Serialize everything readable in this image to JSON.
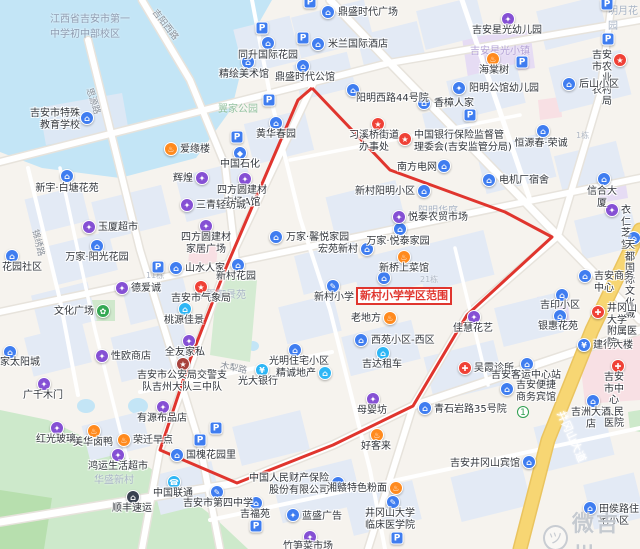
{
  "map": {
    "highlight": {
      "text": "新村小学学区范围",
      "x": 356,
      "y": 287
    },
    "watermark": {
      "text": "微吉州",
      "icon": "bird-face",
      "x": 543,
      "y": 506
    },
    "boundary_color": "#e0352e",
    "boundary_points": "312,88 390,170 505,212 552,237 467,315 413,406 333,445 237,483 160,450 190,360 225,270 298,100 312,88",
    "colors": {
      "blue": "#3f7df0",
      "teal": "#2eb6f5",
      "purple": "#8550d4",
      "orange": "#ff8a1e",
      "red": "#ef4136",
      "darkred": "#a8423c",
      "green": "#34a853",
      "dark": "#39414f",
      "water": "#c3e5f6",
      "park": "#cde9cb",
      "road": "#ffffff",
      "main_road": "#f7d673"
    },
    "pois": [
      {
        "t": "吉安市特殊\n教育学校",
        "x": 87,
        "y": 118,
        "c": "blue",
        "g": "⌂",
        "lx": 80,
        "ly": 108,
        "a": "r"
      },
      {
        "t": "新宇·白塘花苑",
        "x": 67,
        "y": 176,
        "c": "blue",
        "g": "⌂",
        "lx": 67,
        "ly": 183,
        "a": "c"
      },
      {
        "t": "爱缘楼",
        "x": 171,
        "y": 149,
        "c": "orange",
        "g": "♨",
        "lx": 180,
        "ly": 144,
        "a": "l"
      },
      {
        "t": "鼎盛时代广场",
        "x": 328,
        "y": 12,
        "c": "blue",
        "g": "⌂",
        "lx": 338,
        "ly": 7,
        "a": "l"
      },
      {
        "t": "米兰国际酒店",
        "x": 318,
        "y": 44,
        "c": "blue",
        "g": "⌂",
        "lx": 328,
        "ly": 39,
        "a": "l"
      },
      {
        "t": "同升国际花园",
        "x": 268,
        "y": 43,
        "c": "blue",
        "g": "⌂",
        "lx": 268,
        "ly": 50,
        "a": "c"
      },
      {
        "t": "精绘美术馆",
        "x": 248,
        "y": 62,
        "c": "blue",
        "g": "⌂",
        "lx": 244,
        "ly": 69,
        "a": "c"
      },
      {
        "t": "鼎盛时代公馆",
        "x": 303,
        "y": 66,
        "c": "blue",
        "g": "⌂",
        "lx": 305,
        "ly": 72,
        "a": "c"
      },
      {
        "t": "吉安星光幼儿园",
        "x": 508,
        "y": 19,
        "c": "purple",
        "g": "✦",
        "lx": 507,
        "ly": 25,
        "a": "c"
      },
      {
        "t": "海棠树",
        "x": 493,
        "y": 59,
        "c": "orange",
        "g": "♨",
        "lx": 494,
        "ly": 65,
        "a": "c"
      },
      {
        "t": "吉安市农业\n农村局",
        "x": 620,
        "y": 60,
        "c": "red",
        "g": "★",
        "lx": 612,
        "ly": 50,
        "a": "r"
      },
      {
        "t": "后山小区",
        "x": 569,
        "y": 84,
        "c": "blue",
        "g": "⌂",
        "lx": 579,
        "ly": 79,
        "a": "l"
      },
      {
        "t": "阳明公馆幼儿园",
        "x": 459,
        "y": 88,
        "c": "blue",
        "g": "✦",
        "lx": 469,
        "ly": 83,
        "a": "l"
      },
      {
        "t": "香樟人家",
        "x": 424,
        "y": 103,
        "c": "blue",
        "g": "⌂",
        "lx": 434,
        "ly": 98,
        "a": "l"
      },
      {
        "t": "阳明西路44号院",
        "x": 353,
        "y": 90,
        "c": "blue",
        "g": "⌂",
        "lx": 356,
        "ly": 93,
        "a": "l"
      },
      {
        "t": "习溪桥街道\n办事处",
        "x": 378,
        "y": 124,
        "c": "red",
        "g": "★",
        "lx": 374,
        "ly": 130,
        "a": "c"
      },
      {
        "t": "中国银行保险监督管\n理委会(吉安监管分局)",
        "x": 405,
        "y": 139,
        "c": "red",
        "g": "★",
        "lx": 414,
        "ly": 130,
        "a": "l"
      },
      {
        "t": "恒源春·荣诚",
        "x": 543,
        "y": 131,
        "c": "blue",
        "g": "⌂",
        "lx": 541,
        "ly": 138,
        "a": "c"
      },
      {
        "t": "信合大厦",
        "x": 604,
        "y": 179,
        "c": "blue",
        "g": "⌂",
        "lx": 602,
        "ly": 186,
        "a": "c"
      },
      {
        "t": "电机厂宿舍",
        "x": 489,
        "y": 180,
        "c": "blue",
        "g": "⌂",
        "lx": 499,
        "ly": 175,
        "a": "l"
      },
      {
        "t": "南方电网",
        "x": 444,
        "y": 166,
        "c": "blue",
        "g": "⌂",
        "lx": 437,
        "ly": 162,
        "a": "r"
      },
      {
        "t": "衣仁芝堂",
        "x": 612,
        "y": 210,
        "c": "purple",
        "g": "✦",
        "lx": 621,
        "ly": 205,
        "a": "l"
      },
      {
        "t": "辉煌",
        "x": 202,
        "y": 178,
        "c": "purple",
        "g": "✦",
        "lx": 193,
        "ly": 173,
        "a": "r"
      },
      {
        "t": "四方圆建材\n市场A馆",
        "x": 245,
        "y": 179,
        "c": "purple",
        "g": "✦",
        "lx": 242,
        "ly": 185,
        "a": "c"
      },
      {
        "t": "中国石化",
        "x": 240,
        "y": 153,
        "c": "blue",
        "g": "◆",
        "lx": 240,
        "ly": 159,
        "a": "c"
      },
      {
        "t": "黄华春园",
        "x": 276,
        "y": 123,
        "c": "blue",
        "g": "⌂",
        "lx": 276,
        "ly": 129,
        "a": "c"
      },
      {
        "t": "玉厦超市",
        "x": 89,
        "y": 227,
        "c": "purple",
        "g": "✦",
        "lx": 98,
        "ly": 222,
        "a": "l"
      },
      {
        "t": "三青轻纺城",
        "x": 187,
        "y": 205,
        "c": "purple",
        "g": "✦",
        "lx": 196,
        "ly": 200,
        "a": "l"
      },
      {
        "t": "四方圆建材\n家居广场",
        "x": 206,
        "y": 226,
        "c": "purple",
        "g": "✦",
        "lx": 206,
        "ly": 232,
        "a": "c"
      },
      {
        "t": "万家·阳光花园",
        "x": 97,
        "y": 246,
        "c": "blue",
        "g": "⌂",
        "lx": 97,
        "ly": 252,
        "a": "c"
      },
      {
        "t": "花园社区",
        "x": 12,
        "y": 256,
        "c": "blue",
        "g": "⌂",
        "lx": 2,
        "ly": 262,
        "a": "l"
      },
      {
        "t": "山水人家",
        "x": 176,
        "y": 268,
        "c": "blue",
        "g": "⌂",
        "lx": 185,
        "ly": 263,
        "a": "l"
      },
      {
        "t": "新村花园",
        "x": 238,
        "y": 265,
        "c": "blue",
        "g": "⌂",
        "lx": 236,
        "ly": 271,
        "a": "c"
      },
      {
        "t": "吉安市气象局",
        "x": 201,
        "y": 287,
        "c": "red",
        "g": "★",
        "lx": 201,
        "ly": 293,
        "a": "c"
      },
      {
        "t": "德爱诚",
        "x": 122,
        "y": 288,
        "c": "purple",
        "g": "✦",
        "lx": 131,
        "ly": 283,
        "a": "l"
      },
      {
        "t": "文化广场",
        "x": 103,
        "y": 311,
        "c": "green",
        "g": "✿",
        "lx": 94,
        "ly": 306,
        "a": "r"
      },
      {
        "t": "桃源佳景",
        "x": 185,
        "y": 309,
        "c": "teal",
        "g": "⌂",
        "lx": 184,
        "ly": 315,
        "a": "c"
      },
      {
        "t": "万家·馨悦家园",
        "x": 276,
        "y": 237,
        "c": "blue",
        "g": "⌂",
        "lx": 286,
        "ly": 232,
        "a": "l"
      },
      {
        "t": "宏苑新村",
        "x": 367,
        "y": 249,
        "c": "blue",
        "g": "⌂",
        "lx": 358,
        "ly": 244,
        "a": "r"
      },
      {
        "t": "万家·悦泰家园",
        "x": 400,
        "y": 229,
        "c": "blue",
        "g": "⌂",
        "lx": 398,
        "ly": 236,
        "a": "c"
      },
      {
        "t": "悦泰农贸市场",
        "x": 399,
        "y": 217,
        "c": "purple",
        "g": "✦",
        "lx": 408,
        "ly": 212,
        "a": "l"
      },
      {
        "t": "新村阳明小区",
        "x": 424,
        "y": 191,
        "c": "blue",
        "g": "⌂",
        "lx": 415,
        "ly": 186,
        "a": "r"
      },
      {
        "t": "新桥上菜馆",
        "x": 404,
        "y": 257,
        "c": "orange",
        "g": "♨",
        "lx": 404,
        "ly": 263,
        "a": "c"
      },
      {
        "t": "新村小学",
        "x": 333,
        "y": 286,
        "c": "blue",
        "g": "✎",
        "lx": 334,
        "ly": 292,
        "a": "c"
      },
      {
        "t": "",
        "x": 384,
        "y": 278,
        "c": "blue",
        "g": "⌂",
        "lx": 384,
        "ly": 284,
        "a": "c"
      },
      {
        "t": "老地方",
        "x": 390,
        "y": 318,
        "c": "orange",
        "g": "♨",
        "lx": 381,
        "ly": 313,
        "a": "r"
      },
      {
        "t": "西苑小区-西区",
        "x": 361,
        "y": 340,
        "c": "blue",
        "g": "⌂",
        "lx": 371,
        "ly": 335,
        "a": "l"
      },
      {
        "t": "吉达租车",
        "x": 383,
        "y": 353,
        "c": "teal",
        "g": "⌂",
        "lx": 382,
        "ly": 359,
        "a": "c"
      },
      {
        "t": "光明住宅小区",
        "x": 295,
        "y": 350,
        "c": "blue",
        "g": "⌂",
        "lx": 299,
        "ly": 356,
        "a": "c"
      },
      {
        "t": "光大银行",
        "x": 262,
        "y": 370,
        "c": "teal",
        "g": "¥",
        "lx": 258,
        "ly": 376,
        "a": "c"
      },
      {
        "t": "精诚地产",
        "x": 325,
        "y": 373,
        "c": "teal",
        "g": "⌂",
        "lx": 316,
        "ly": 368,
        "a": "r"
      },
      {
        "t": "佳慧花艺",
        "x": 474,
        "y": 317,
        "c": "purple",
        "g": "✦",
        "lx": 473,
        "ly": 323,
        "a": "c"
      },
      {
        "t": "吴霞诊所",
        "x": 465,
        "y": 368,
        "c": "red",
        "g": "✚",
        "lx": 474,
        "ly": 363,
        "a": "l"
      },
      {
        "t": "吉安客运中心站",
        "x": 527,
        "y": 364,
        "c": "blue",
        "g": "⌂",
        "lx": 526,
        "ly": 370,
        "a": "c"
      },
      {
        "t": "吉安便捷\n商务宾馆",
        "x": 507,
        "y": 389,
        "c": "blue",
        "g": "⌂",
        "lx": 516,
        "ly": 380,
        "a": "l"
      },
      {
        "t": "建行大楼",
        "x": 584,
        "y": 345,
        "c": "blue",
        "g": "¥",
        "lx": 593,
        "ly": 340,
        "a": "l"
      },
      {
        "t": "吉安市中心\n人民医院",
        "x": 618,
        "y": 366,
        "c": "red",
        "g": "✚",
        "lx": 614,
        "ly": 372,
        "a": "c"
      },
      {
        "t": "吉洲大酒店",
        "x": 593,
        "y": 401,
        "c": "blue",
        "g": "⌂",
        "lx": 591,
        "ly": 407,
        "a": "c"
      },
      {
        "t": "天都国际\n文化城",
        "x": 634,
        "y": 238,
        "c": "blue",
        "g": "⌂",
        "lx": 625,
        "ly": 240,
        "a": "l"
      },
      {
        "t": "吉安商务中心",
        "x": 585,
        "y": 276,
        "c": "blue",
        "g": "⌂",
        "lx": 594,
        "ly": 271,
        "a": "l"
      },
      {
        "t": "吉印小区",
        "x": 562,
        "y": 295,
        "c": "blue",
        "g": "⌂",
        "lx": 560,
        "ly": 300,
        "a": "c"
      },
      {
        "t": "井冈山大学\n附属医院",
        "x": 598,
        "y": 312,
        "c": "red",
        "g": "✚",
        "lx": 607,
        "ly": 303,
        "a": "l"
      },
      {
        "t": "银惠花苑",
        "x": 560,
        "y": 316,
        "c": "blue",
        "g": "⌂",
        "lx": 558,
        "ly": 321,
        "a": "c"
      },
      {
        "t": "母婴坊",
        "x": 373,
        "y": 399,
        "c": "purple",
        "g": "✦",
        "lx": 372,
        "ly": 405,
        "a": "c"
      },
      {
        "t": "好客来",
        "x": 377,
        "y": 435,
        "c": "orange",
        "g": "♨",
        "lx": 376,
        "ly": 441,
        "a": "c"
      },
      {
        "t": "青石岩路35号院",
        "x": 425,
        "y": 408,
        "c": "blue",
        "g": "⌂",
        "lx": 434,
        "ly": 404,
        "a": "l"
      },
      {
        "t": "国槐花园里",
        "x": 177,
        "y": 455,
        "c": "blue",
        "g": "⌂",
        "lx": 186,
        "ly": 450,
        "a": "l"
      },
      {
        "t": "美华卤鸭",
        "x": 94,
        "y": 431,
        "c": "orange",
        "g": "♨",
        "lx": 93,
        "ly": 437,
        "a": "c"
      },
      {
        "t": "荣迁早点",
        "x": 124,
        "y": 440,
        "c": "orange",
        "g": "♨",
        "lx": 133,
        "ly": 435,
        "a": "l"
      },
      {
        "t": "红光玻璃",
        "x": 57,
        "y": 428,
        "c": "purple",
        "g": "✦",
        "lx": 56,
        "ly": 434,
        "a": "c"
      },
      {
        "t": "广千木门",
        "x": 44,
        "y": 384,
        "c": "purple",
        "g": "✦",
        "lx": 43,
        "ly": 390,
        "a": "c"
      },
      {
        "t": "鸿运生活超市",
        "x": 118,
        "y": 455,
        "c": "purple",
        "g": "✦",
        "lx": 118,
        "ly": 461,
        "a": "c"
      },
      {
        "t": "顺丰速运",
        "x": 133,
        "y": 497,
        "c": "dark",
        "g": "⌂",
        "lx": 132,
        "ly": 503,
        "a": "c"
      },
      {
        "t": "家太阳城",
        "x": 10,
        "y": 352,
        "c": "blue",
        "g": "⌂",
        "lx": 0,
        "ly": 357,
        "a": "l"
      },
      {
        "t": "性欧商店",
        "x": 102,
        "y": 356,
        "c": "purple",
        "g": "✦",
        "lx": 111,
        "ly": 351,
        "a": "l"
      },
      {
        "t": "吉安市公安局交警支\n队吉州大队三中队",
        "x": 183,
        "y": 364,
        "c": "darkred",
        "g": "★",
        "lx": 182,
        "ly": 370,
        "a": "c"
      },
      {
        "t": "全友家私",
        "x": 189,
        "y": 341,
        "c": "purple",
        "g": "✦",
        "lx": 185,
        "ly": 347,
        "a": "c"
      },
      {
        "t": "有源布品店",
        "x": 163,
        "y": 407,
        "c": "purple",
        "g": "✦",
        "lx": 162,
        "ly": 413,
        "a": "c"
      },
      {
        "t": "中国联通",
        "x": 174,
        "y": 482,
        "c": "teal",
        "g": "☎",
        "lx": 173,
        "ly": 488,
        "a": "c"
      },
      {
        "t": "吉安市第四中学",
        "x": 217,
        "y": 492,
        "c": "blue",
        "g": "✎",
        "lx": 218,
        "ly": 498,
        "a": "c"
      },
      {
        "t": "中国人民财产保险\n股份有限公司",
        "x": 338,
        "y": 483,
        "c": "blue",
        "g": "⌂",
        "lx": 329,
        "ly": 473,
        "a": "r"
      },
      {
        "t": "湘赣特色粉面",
        "x": 396,
        "y": 488,
        "c": "orange",
        "g": "♨",
        "lx": 387,
        "ly": 483,
        "a": "r"
      },
      {
        "t": "井冈山大学\n临床医学院",
        "x": 393,
        "y": 502,
        "c": "blue",
        "g": "✎",
        "lx": 390,
        "ly": 508,
        "a": "c"
      },
      {
        "t": "吉福苑",
        "x": 256,
        "y": 503,
        "c": "blue",
        "g": "⌂",
        "lx": 255,
        "ly": 509,
        "a": "c"
      },
      {
        "t": "蓝盛广告",
        "x": 293,
        "y": 515,
        "c": "blue",
        "g": "✦",
        "lx": 302,
        "ly": 511,
        "a": "l"
      },
      {
        "t": "竹笋菜市场",
        "x": 310,
        "y": 537,
        "c": "purple",
        "g": "✦",
        "lx": 308,
        "ly": 541,
        "a": "c"
      },
      {
        "t": "吉安井冈山宾馆",
        "x": 529,
        "y": 462,
        "c": "blue",
        "g": "⌂",
        "lx": 520,
        "ly": 458,
        "a": "r"
      },
      {
        "t": "田侯路住宅小区",
        "x": 590,
        "y": 508,
        "c": "blue",
        "g": "⌂",
        "lx": 599,
        "ly": 504,
        "a": "l"
      }
    ],
    "parkings": [
      {
        "x": 262,
        "y": 28
      },
      {
        "x": 310,
        "y": 2
      },
      {
        "x": 303,
        "y": 38
      },
      {
        "x": 607,
        "y": 4
      },
      {
        "x": 608,
        "y": 39
      },
      {
        "x": 522,
        "y": 62
      },
      {
        "x": 470,
        "y": 115
      },
      {
        "x": 237,
        "y": 137
      },
      {
        "x": 269,
        "y": 100
      },
      {
        "x": 158,
        "y": 267
      },
      {
        "x": 216,
        "y": 428
      },
      {
        "x": 200,
        "y": 440
      },
      {
        "x": 256,
        "y": 526
      },
      {
        "x": 397,
        "y": 538
      }
    ],
    "badges": [
      {
        "t": "①",
        "x": 523,
        "y": 412
      }
    ],
    "road_labels": [
      {
        "t": "吉阳西路",
        "x": 160,
        "y": 6,
        "r": 52,
        "c": "#8a9099",
        "s": 9
      },
      {
        "t": "思源路",
        "x": 96,
        "y": 86,
        "r": 72,
        "c": "#8a9099",
        "s": 9
      },
      {
        "t": "锦绣路",
        "x": 42,
        "y": 228,
        "r": 76,
        "c": "#8a9099",
        "s": 9
      },
      {
        "t": "木犁路",
        "x": 222,
        "y": 358,
        "r": 12,
        "c": "#8a9099",
        "s": 9
      },
      {
        "t": "井冈山大道",
        "x": 568,
        "y": 408,
        "r": 66,
        "c": "#ffffff",
        "s": 11
      }
    ],
    "area_labels": [
      {
        "t": "江西省吉安市第一\n中学初中部校区",
        "x": 50,
        "y": 10,
        "c": "#8e9bb0",
        "s": 10
      },
      {
        "t": "翼家公园",
        "x": 218,
        "y": 100,
        "c": "#94c2a0",
        "s": 10
      },
      {
        "t": "吉安星光小镇",
        "x": 470,
        "y": 42,
        "c": "#b4a3d6",
        "s": 10
      },
      {
        "t": "阳明华庭",
        "x": 418,
        "y": 202,
        "c": "#a8b4c6",
        "s": 10
      },
      {
        "t": "华夏御景苑",
        "x": 196,
        "y": 286,
        "c": "#a8b4c6",
        "s": 10
      },
      {
        "t": "华盛新村",
        "x": 94,
        "y": 471,
        "c": "#a8b4c6",
        "s": 10
      },
      {
        "t": "明月花园",
        "x": 608,
        "y": 2,
        "c": "#a8b4c6",
        "s": 10
      },
      {
        "t": "1栋",
        "x": 576,
        "y": 130,
        "c": "#b0b8c4",
        "s": 8
      },
      {
        "t": "21栋",
        "x": 420,
        "y": 274,
        "c": "#b0b8c4",
        "s": 8
      },
      {
        "t": "11栋",
        "x": 146,
        "y": 270,
        "c": "#b0b8c4",
        "s": 8
      }
    ]
  }
}
